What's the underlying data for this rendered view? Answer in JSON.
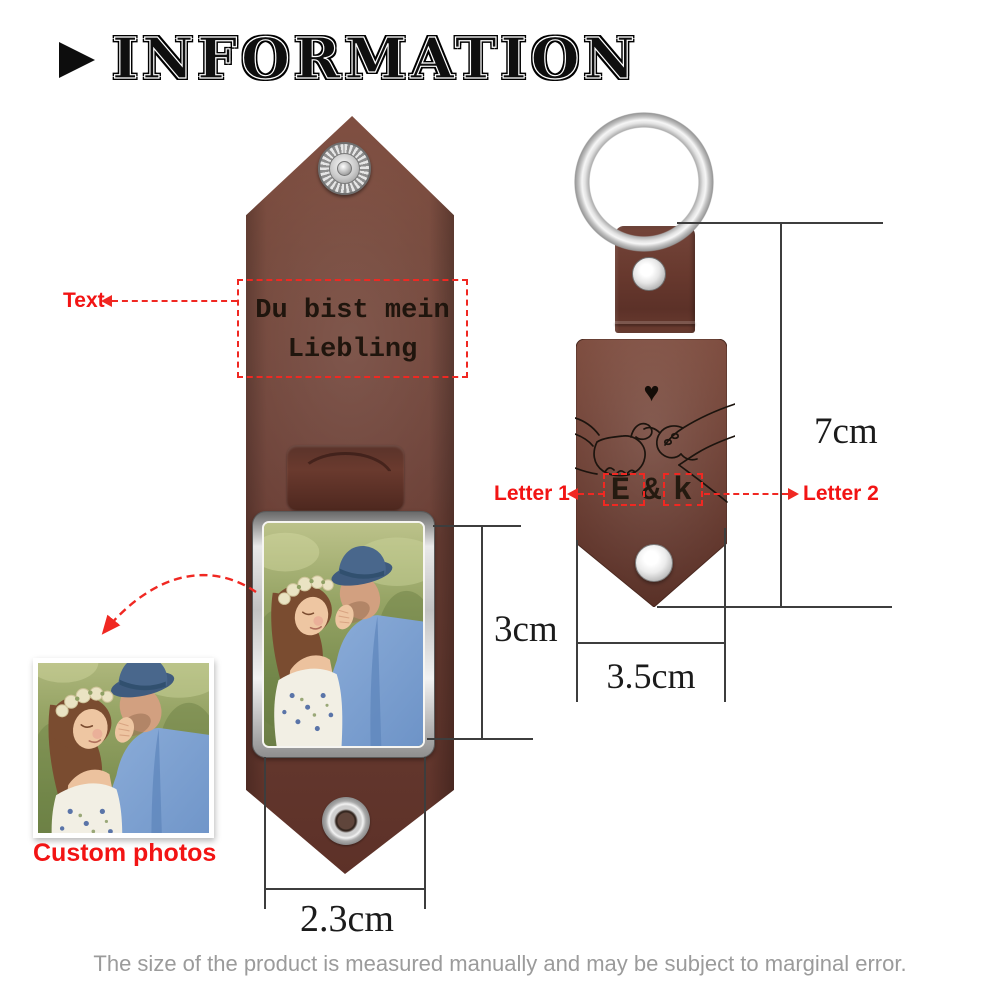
{
  "title": {
    "text": "INFORMATION"
  },
  "open_keychain": {
    "text_label": "Text",
    "engraving_line1": "Du bist mein",
    "engraving_line2": "Liebling",
    "photo_height": "3cm",
    "width": "2.3cm",
    "custom_photos_label": "Custom photos"
  },
  "closed_keychain": {
    "heart_icon": "♥",
    "letter1": "E",
    "ampersand": "&",
    "letter2": "k",
    "letter1_label": "Letter 1",
    "letter2_label": "Letter 2",
    "height": "7cm",
    "width": "3.5cm"
  },
  "footer": {
    "note": "The size of the product is measured manually and may be subject to marginal error."
  },
  "colors": {
    "accent_red": "#f21414",
    "dashed_red": "#f02822",
    "leather_brown": "#6e4136",
    "leather_brown_dark": "#5c3128",
    "metal_silver": "#d6d6d6",
    "dimension_line": "#3d3d3d",
    "caption_gray": "#9b9b9b",
    "engraving_black": "#221811"
  }
}
